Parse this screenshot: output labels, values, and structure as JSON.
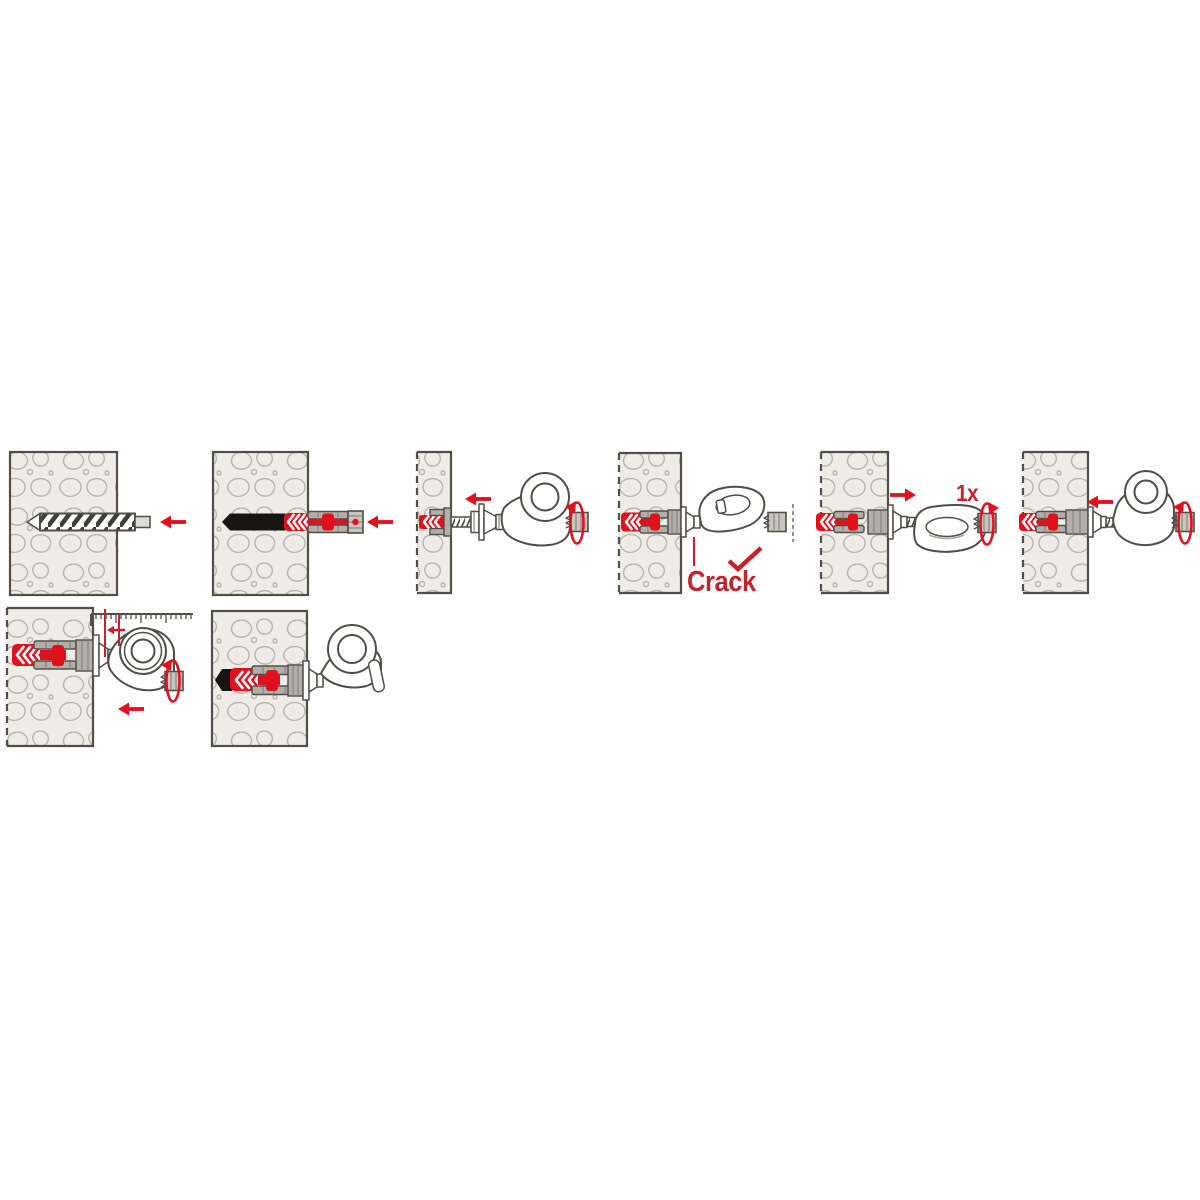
{
  "page": {
    "title": "Wall plug with eye hook installation instructions",
    "background": "#ffffff"
  },
  "colors": {
    "red": "#e2101d",
    "text_red": "#c8202c",
    "outline": "#504e49",
    "wall_fill": "#edece7",
    "blob_stroke": "#b8b6af",
    "metal_gray": "#c9c6c0",
    "plug_gray": "#b2afa8",
    "black": "#161513",
    "white": "#ffffff"
  },
  "labels": {
    "crack": "Crack",
    "turns": "1x"
  },
  "steps": [
    {
      "step": 1,
      "name": "drill-hole",
      "icons": [
        "wall-cross-section",
        "drill-bit",
        "arrow-left-icon"
      ]
    },
    {
      "step": 2,
      "name": "insert-plug",
      "icons": [
        "wall-cross-section",
        "wall-plug",
        "arrow-left-icon"
      ]
    },
    {
      "step": 3,
      "name": "screw-in-eye-hook",
      "icons": [
        "wall-cross-section",
        "wall-plug",
        "screw",
        "eye-hook",
        "arrow-left-icon",
        "rotation-arrow-icon",
        "torx-bit-icon"
      ]
    },
    {
      "step": 4,
      "name": "tighten-until-crack",
      "icons": [
        "wall-cross-section",
        "wall-plug",
        "eye-hook",
        "checkmark-icon",
        "torx-bit-icon"
      ],
      "label": "Crack"
    },
    {
      "step": 5,
      "name": "turn-back-one-turn",
      "icons": [
        "wall-cross-section",
        "wall-plug",
        "eye-hook",
        "arrow-right-icon",
        "rotation-arrow-icon",
        "torx-bit-icon"
      ],
      "label": "1x"
    },
    {
      "step": 6,
      "name": "screw-in-until-flush",
      "icons": [
        "wall-cross-section",
        "wall-plug",
        "eye-hook",
        "arrow-left-icon",
        "rotation-arrow-icon",
        "torx-bit-icon"
      ]
    },
    {
      "step": 7,
      "name": "adjust-distance-with-ruler",
      "icons": [
        "wall-cross-section",
        "wall-plug",
        "eye-hook",
        "ruler",
        "measure-lines",
        "small-arrow-left-icon",
        "arrow-left-icon",
        "rotation-arrow-icon",
        "torx-bit-icon"
      ]
    },
    {
      "step": 8,
      "name": "installed-final",
      "icons": [
        "wall-cross-section",
        "wall-plug",
        "eye-hook"
      ]
    }
  ]
}
